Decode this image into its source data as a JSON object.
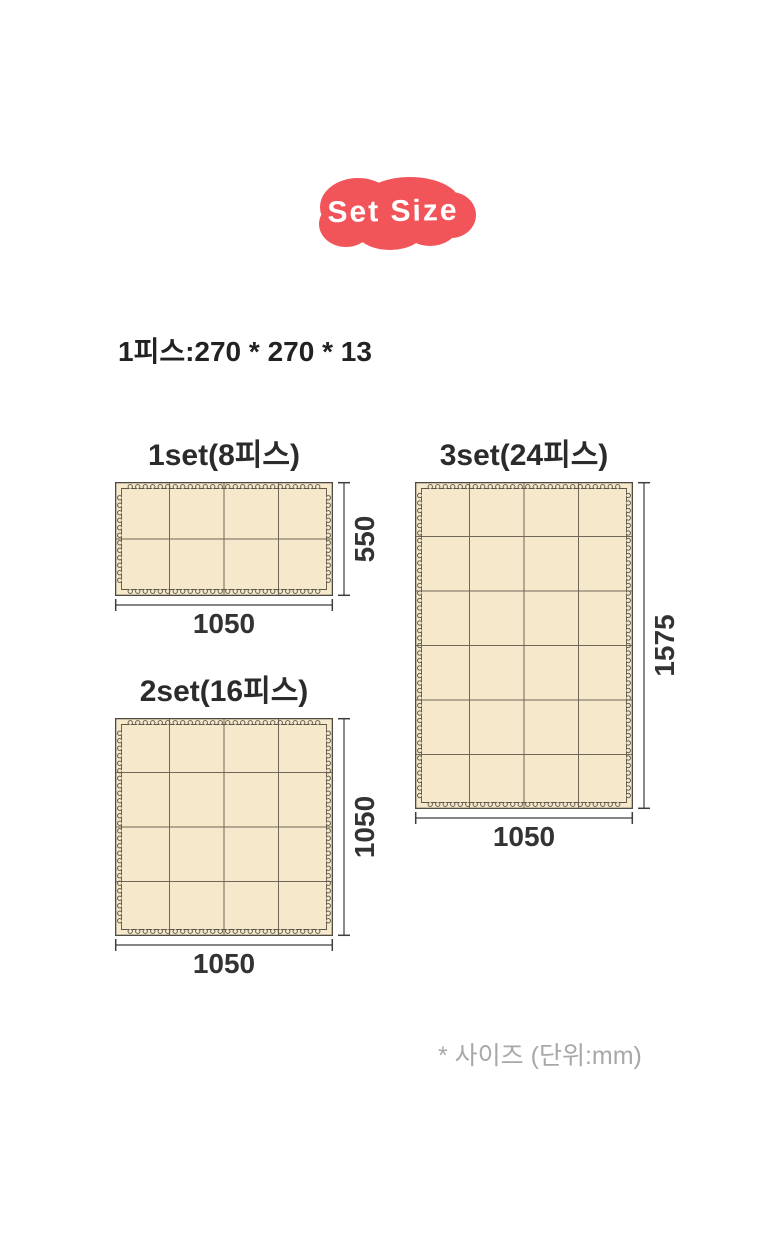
{
  "badge": {
    "label": "Set Size",
    "fill": "#f25559",
    "text_color": "#ffffff"
  },
  "piece_info": {
    "text": "1피스:270 * 270 * 13"
  },
  "footnote": {
    "text": "* 사이즈 (단위:mm)"
  },
  "diagram": {
    "unit": "mm",
    "colors": {
      "page_bg": "#ffffff",
      "mat_fill": "#f6e9cb",
      "mat_border": "#4f4b43",
      "grid_line": "#6e675a",
      "puzzle_edge": "#5c564b",
      "dim_line": "#3e3e3e",
      "dim_text": "#333333",
      "footnote_text": "#a8a8a8"
    },
    "mats": [
      {
        "title": "1set(8피스)",
        "pieces": 8,
        "cols": 4,
        "rows": 2,
        "width_mm": 1050,
        "height_mm": 550,
        "width_label": "1050",
        "height_label": "550"
      },
      {
        "title": "3set(24피스)",
        "pieces": 24,
        "cols": 4,
        "rows": 6,
        "width_mm": 1050,
        "height_mm": 1575,
        "width_label": "1050",
        "height_label": "1575"
      },
      {
        "title": "2set(16피스)",
        "pieces": 16,
        "cols": 4,
        "rows": 4,
        "width_mm": 1050,
        "height_mm": 1050,
        "width_label": "1050",
        "height_label": "1050"
      }
    ]
  }
}
